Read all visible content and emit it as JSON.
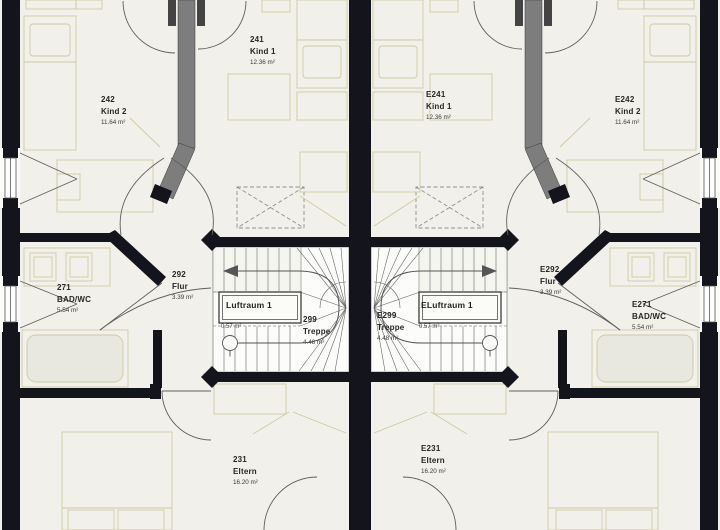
{
  "rooms": [
    {
      "number": "241",
      "name": "Kind 1",
      "area": "12.36 m²"
    },
    {
      "number": "242",
      "name": "Kind 2",
      "area": "11.64 m²"
    },
    {
      "number": "E241",
      "name": "Kind 1",
      "area": "12.36 m²"
    },
    {
      "number": "E242",
      "name": "Kind 2",
      "area": "11.64 m²"
    },
    {
      "number": "271",
      "name": "BAD/WC",
      "area": "5.54 m²"
    },
    {
      "number": "292",
      "name": "Flur",
      "area": "3.39 m²"
    },
    {
      "number": "E292",
      "name": "Flur",
      "area": "3.39 m²"
    },
    {
      "number": "E271",
      "name": "BAD/WC",
      "area": "5.54 m²"
    },
    {
      "number": "299",
      "name": "Treppe",
      "area": "4.48 m²"
    },
    {
      "number": "E299",
      "name": "Treppe",
      "area": "4.48 m²"
    },
    {
      "number": "231",
      "name": "Eltern",
      "area": "16.20 m²"
    },
    {
      "number": "E231",
      "name": "Eltern",
      "area": "16.20 m²"
    }
  ],
  "voids": [
    {
      "label": "Luftraum 1",
      "area": "0.57 m²"
    },
    {
      "label": "ELuftraum 1",
      "area": "0.57 m²"
    }
  ],
  "colors": {
    "floor": "#f1f0ea",
    "wall": "#14141c",
    "stair_floor": "#fcfcfa",
    "furniture_line": "#cfcaa2",
    "chimney": "#7d7d7d",
    "door_arc": "#5f5f5f",
    "dashed_marker": "#8f8f8f",
    "text": "#262626"
  }
}
